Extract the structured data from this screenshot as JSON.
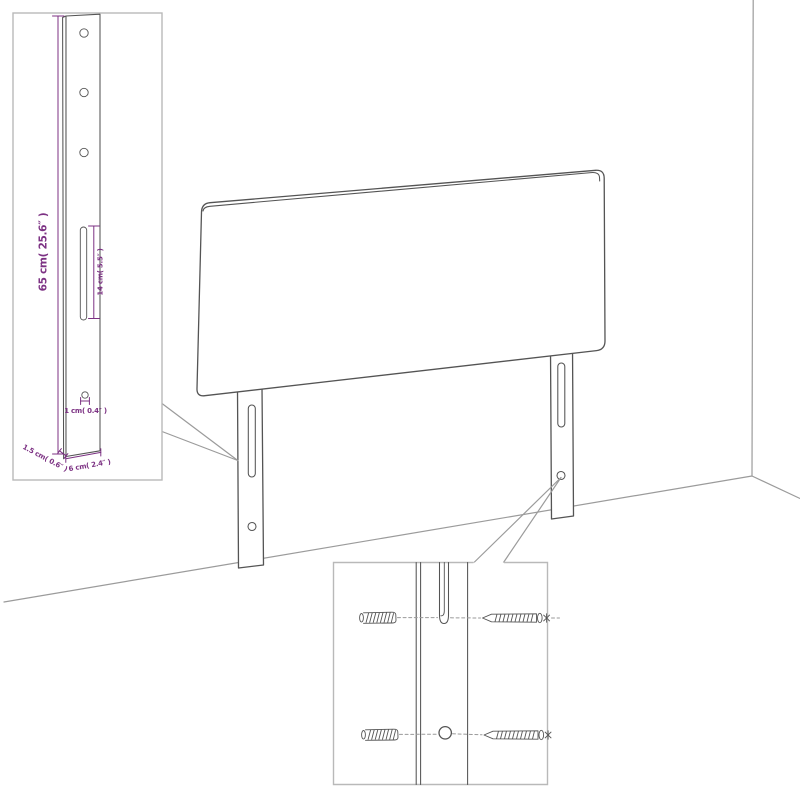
{
  "colors": {
    "background": "#ffffff",
    "outline": "#545454",
    "room_line": "#9b9b9b",
    "inset_border": "#b9b9b9",
    "dimension": "#7c3183"
  },
  "leg_detail_inset": {
    "height_label": "65 cm( 25.6″ )",
    "slot_label": "14 cm( 5.5″ )",
    "hole_label": "1 cm( 0.4″ )",
    "side_label": "1.5 cm( 0.6″ )",
    "width_label": "6 cm( 2.4″ )"
  },
  "hardware_inset": {
    "wall_plug_icon": "hatched-cylinder-wall-plug",
    "screw_icon": "pointed-screw-with-cross-head"
  }
}
